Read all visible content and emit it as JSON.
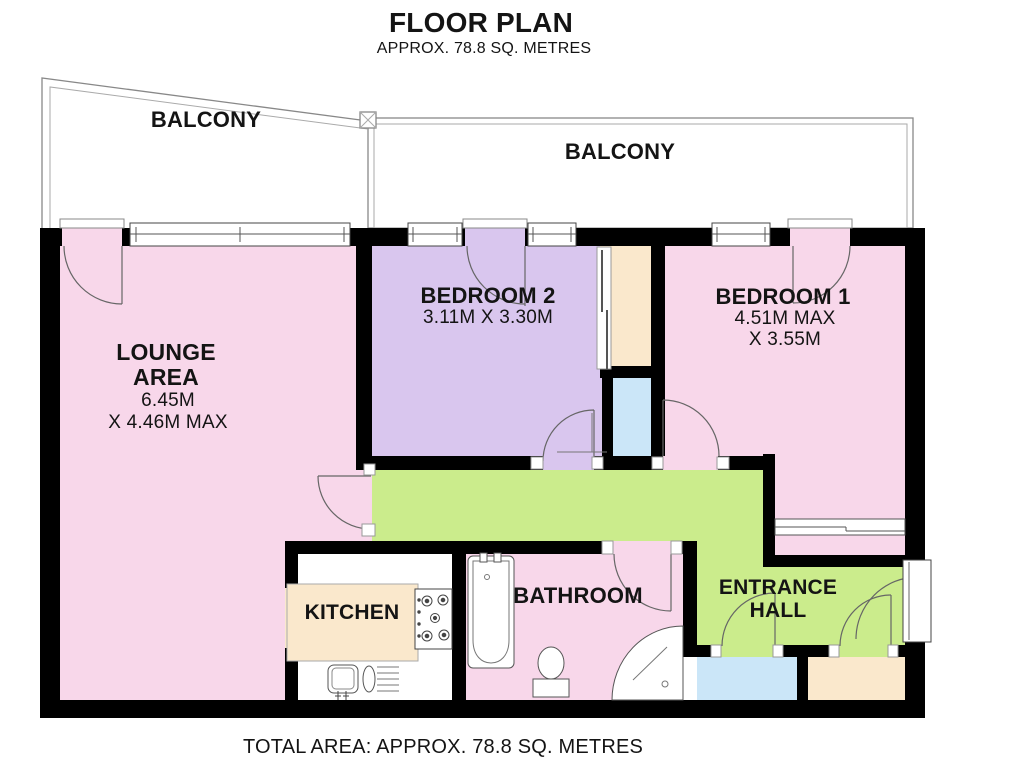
{
  "header": {
    "title": "FLOOR PLAN",
    "subtitle": "APPROX. 78.8 SQ. METRES"
  },
  "footer": {
    "total_area": "TOTAL AREA: APPROX. 78.8 SQ. METRES"
  },
  "rooms": {
    "balcony_left": {
      "label": "BALCONY"
    },
    "balcony_right": {
      "label": "BALCONY"
    },
    "lounge": {
      "name_line1": "LOUNGE",
      "name_line2": "AREA",
      "dim_line1": "6.45M",
      "dim_line2": "X 4.46M MAX"
    },
    "bedroom2": {
      "name": "BEDROOM 2",
      "dims": "3.11M X 3.30M"
    },
    "bedroom1": {
      "name": "BEDROOM 1",
      "dim_line1": "4.51M MAX",
      "dim_line2": "X 3.55M"
    },
    "kitchen": {
      "name": "KITCHEN"
    },
    "bathroom": {
      "name": "BATHROOM"
    },
    "entrance_hall": {
      "name_line1": "ENTRANCE",
      "name_line2": "HALL"
    }
  },
  "colors": {
    "room_pink": "#F8D7EA",
    "room_purple": "#D9C6EE",
    "hall_green": "#CBEC8C",
    "closet_cream": "#FAE8CC",
    "closet_blue": "#CBE6F8",
    "wall": "#000000"
  }
}
